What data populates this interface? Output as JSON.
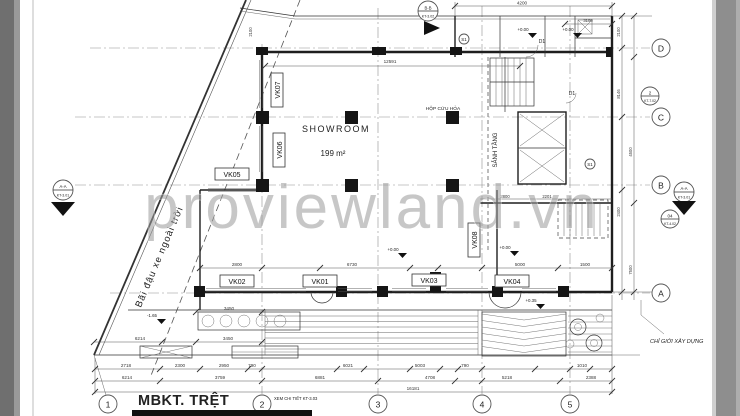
{
  "watermark": "proviewland.vn",
  "title": {
    "text": "MBKT. TRỆT"
  },
  "notes": {
    "see_detail": "XEM CHI TIẾT KT-3.03",
    "boundary": "CHỈ GIỚI XÂY DỰNG",
    "parking": "Bãi đậu xe ngoài trời"
  },
  "rooms": {
    "showroom": "SHOWROOM",
    "showroom_area": "199 m²",
    "lobby": "SẢNH TẦNG",
    "firebox": "HỘP CỨU HỎA"
  },
  "tags": {
    "vk01": "VK01",
    "vk02": "VK02",
    "vk03": "VK03",
    "vk04": "VK04",
    "vk05": "VK05",
    "vk06": "VK06",
    "vk07": "VK07",
    "vk08": "VK08",
    "d1": "D1",
    "s1": "S1"
  },
  "levels": {
    "zero": "+0.00",
    "plus": "+0.35",
    "minus": "-1.65"
  },
  "grid": {
    "cols": [
      "1",
      "2",
      "3",
      "4",
      "5"
    ],
    "rows": [
      "D",
      "C",
      "B",
      "A"
    ]
  },
  "markers": {
    "section_a": {
      "label": "A-A",
      "ref": "KT-3.01"
    },
    "section_b": {
      "label": "B-B",
      "ref": "KT-3.02"
    },
    "detail_2": {
      "num": "2",
      "ref": "KT-7.02"
    },
    "detail_04": {
      "num": "04",
      "ref": "KT-4.02"
    }
  },
  "dims": {
    "top": [
      "4200",
      "3100"
    ],
    "showroom_width": "12591",
    "window_row": [
      "2800",
      "6730",
      "5000",
      "1500"
    ],
    "room_small": [
      "2800",
      "2201"
    ],
    "row1": [
      "2718",
      "2300",
      "2950",
      "790",
      "6021",
      "5003",
      "790",
      "1010"
    ],
    "row2": [
      "6214",
      "3759",
      "6881",
      "4708",
      "5218",
      "2388"
    ],
    "total": "16181",
    "left": [
      "6214",
      "3450",
      "3450"
    ],
    "right": [
      "2100",
      "8146",
      "4500",
      "2400",
      "7500"
    ]
  }
}
